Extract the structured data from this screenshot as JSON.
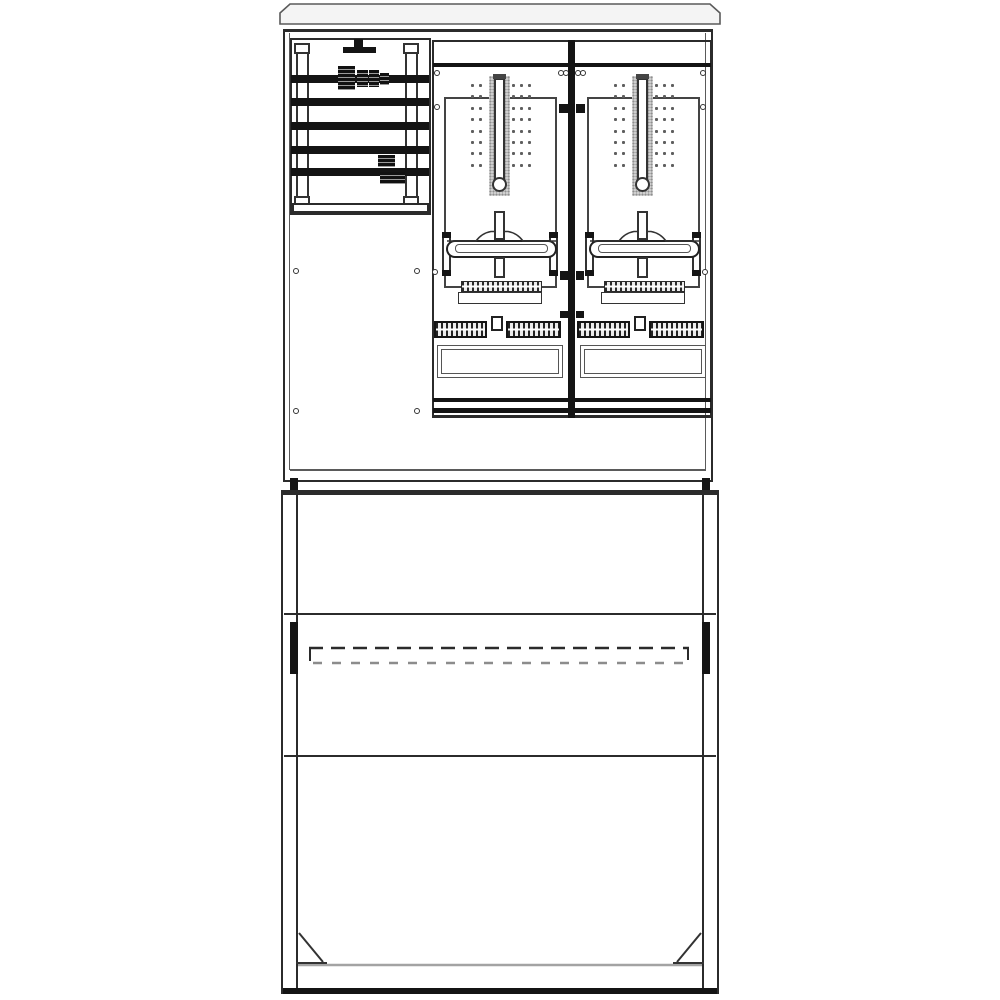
{
  "subject": "electrical-meter-cabinet-technical-line-drawing",
  "colors": {
    "background": "#ffffff",
    "line": "#2b2b2b",
    "line_soft": "#5a5a5a",
    "fill_black": "#141414",
    "cap_fill": "#f4f4f4",
    "stipple_fill": "#cfcfcf",
    "dot": "#5f5f5f",
    "skirt_line": "#a3a3a3",
    "dash_soft": "#8c8c8c"
  },
  "cabinet": {
    "busbar_compartment": {
      "busbar_count": 5,
      "busbar_ys": [
        75,
        98,
        122,
        146,
        168
      ],
      "clamps": [
        {
          "type": "A",
          "x": 338,
          "y": 66
        },
        {
          "type": "B",
          "x": 378,
          "y": 155
        }
      ]
    },
    "meter_fields": {
      "count": 2,
      "origins_x": [
        433,
        576
      ],
      "dot_grid": {
        "rows": 8,
        "start_y": 84,
        "step_y": 11.4,
        "col_offsets": [
          38,
          46,
          79,
          87,
          95
        ],
        "dot_size": 3
      }
    },
    "screws": [
      [
        437,
        73
      ],
      [
        437,
        107
      ],
      [
        561,
        73
      ],
      [
        566,
        73
      ],
      [
        578,
        73
      ],
      [
        583,
        73
      ],
      [
        703,
        73
      ],
      [
        703,
        107
      ],
      [
        296,
        271
      ],
      [
        417,
        271
      ],
      [
        296,
        411
      ],
      [
        417,
        411
      ],
      [
        435,
        272
      ],
      [
        705,
        272
      ]
    ],
    "clamp_marks": [
      [
        559,
        104,
        9,
        9
      ],
      [
        576,
        104,
        9,
        9
      ],
      [
        560,
        271,
        8,
        9
      ],
      [
        576,
        271,
        8,
        9
      ],
      [
        560,
        311,
        8,
        7
      ],
      [
        576,
        311,
        8,
        7
      ]
    ]
  },
  "base": {
    "knockout_dash": {
      "x1": 309,
      "x2": 689,
      "y_top": 648,
      "y_bottom": 663
    },
    "side_bracket_count": 2,
    "corner_gusset_count": 2
  }
}
